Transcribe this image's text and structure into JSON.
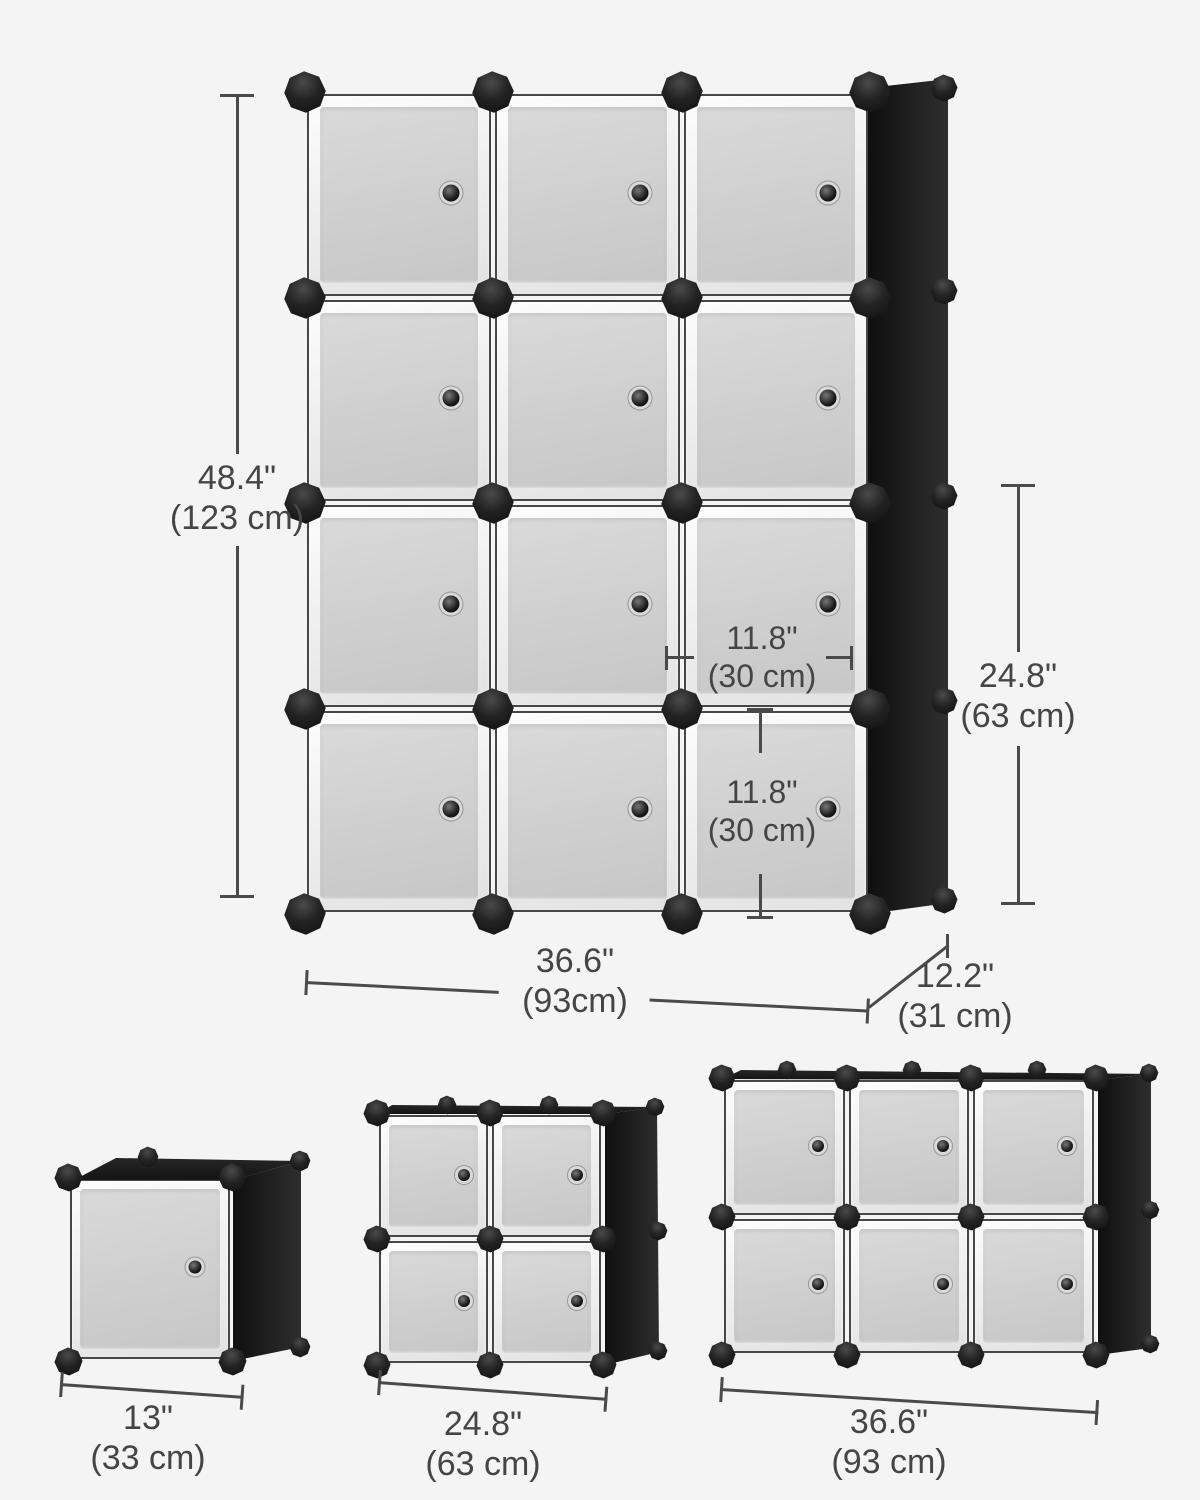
{
  "page": {
    "background_color": "#f4f4f4",
    "dimension_line_color": "#4a4a4a",
    "dimension_text_color": "#454545",
    "frame_color": "#1c1c1c",
    "door_color": "#d4d4d4"
  },
  "main_unit": {
    "cube_count": 12,
    "grid_rows": 4,
    "grid_cols": 3,
    "dims": {
      "height": {
        "inches": "48.4\"",
        "metric": "(123 cm)"
      },
      "width": {
        "inches": "36.6\"",
        "metric": "(93cm)"
      },
      "depth": {
        "inches": "12.2\"",
        "metric": "(31 cm)"
      },
      "stack_height": {
        "inches": "24.8\"",
        "metric": "(63 cm)"
      },
      "cube_width": {
        "inches": "11.8\"",
        "metric": "(30 cm)"
      },
      "cube_height": {
        "inches": "11.8\"",
        "metric": "(30 cm)"
      }
    }
  },
  "variant_units": [
    {
      "cube_count": 1,
      "grid_rows": 1,
      "grid_cols": 1,
      "width": {
        "inches": "13\"",
        "metric": "(33 cm)"
      }
    },
    {
      "cube_count": 4,
      "grid_rows": 2,
      "grid_cols": 2,
      "width": {
        "inches": "24.8\"",
        "metric": "(63 cm)"
      }
    },
    {
      "cube_count": 6,
      "grid_rows": 2,
      "grid_cols": 3,
      "width": {
        "inches": "36.6\"",
        "metric": "(93 cm)"
      }
    }
  ]
}
